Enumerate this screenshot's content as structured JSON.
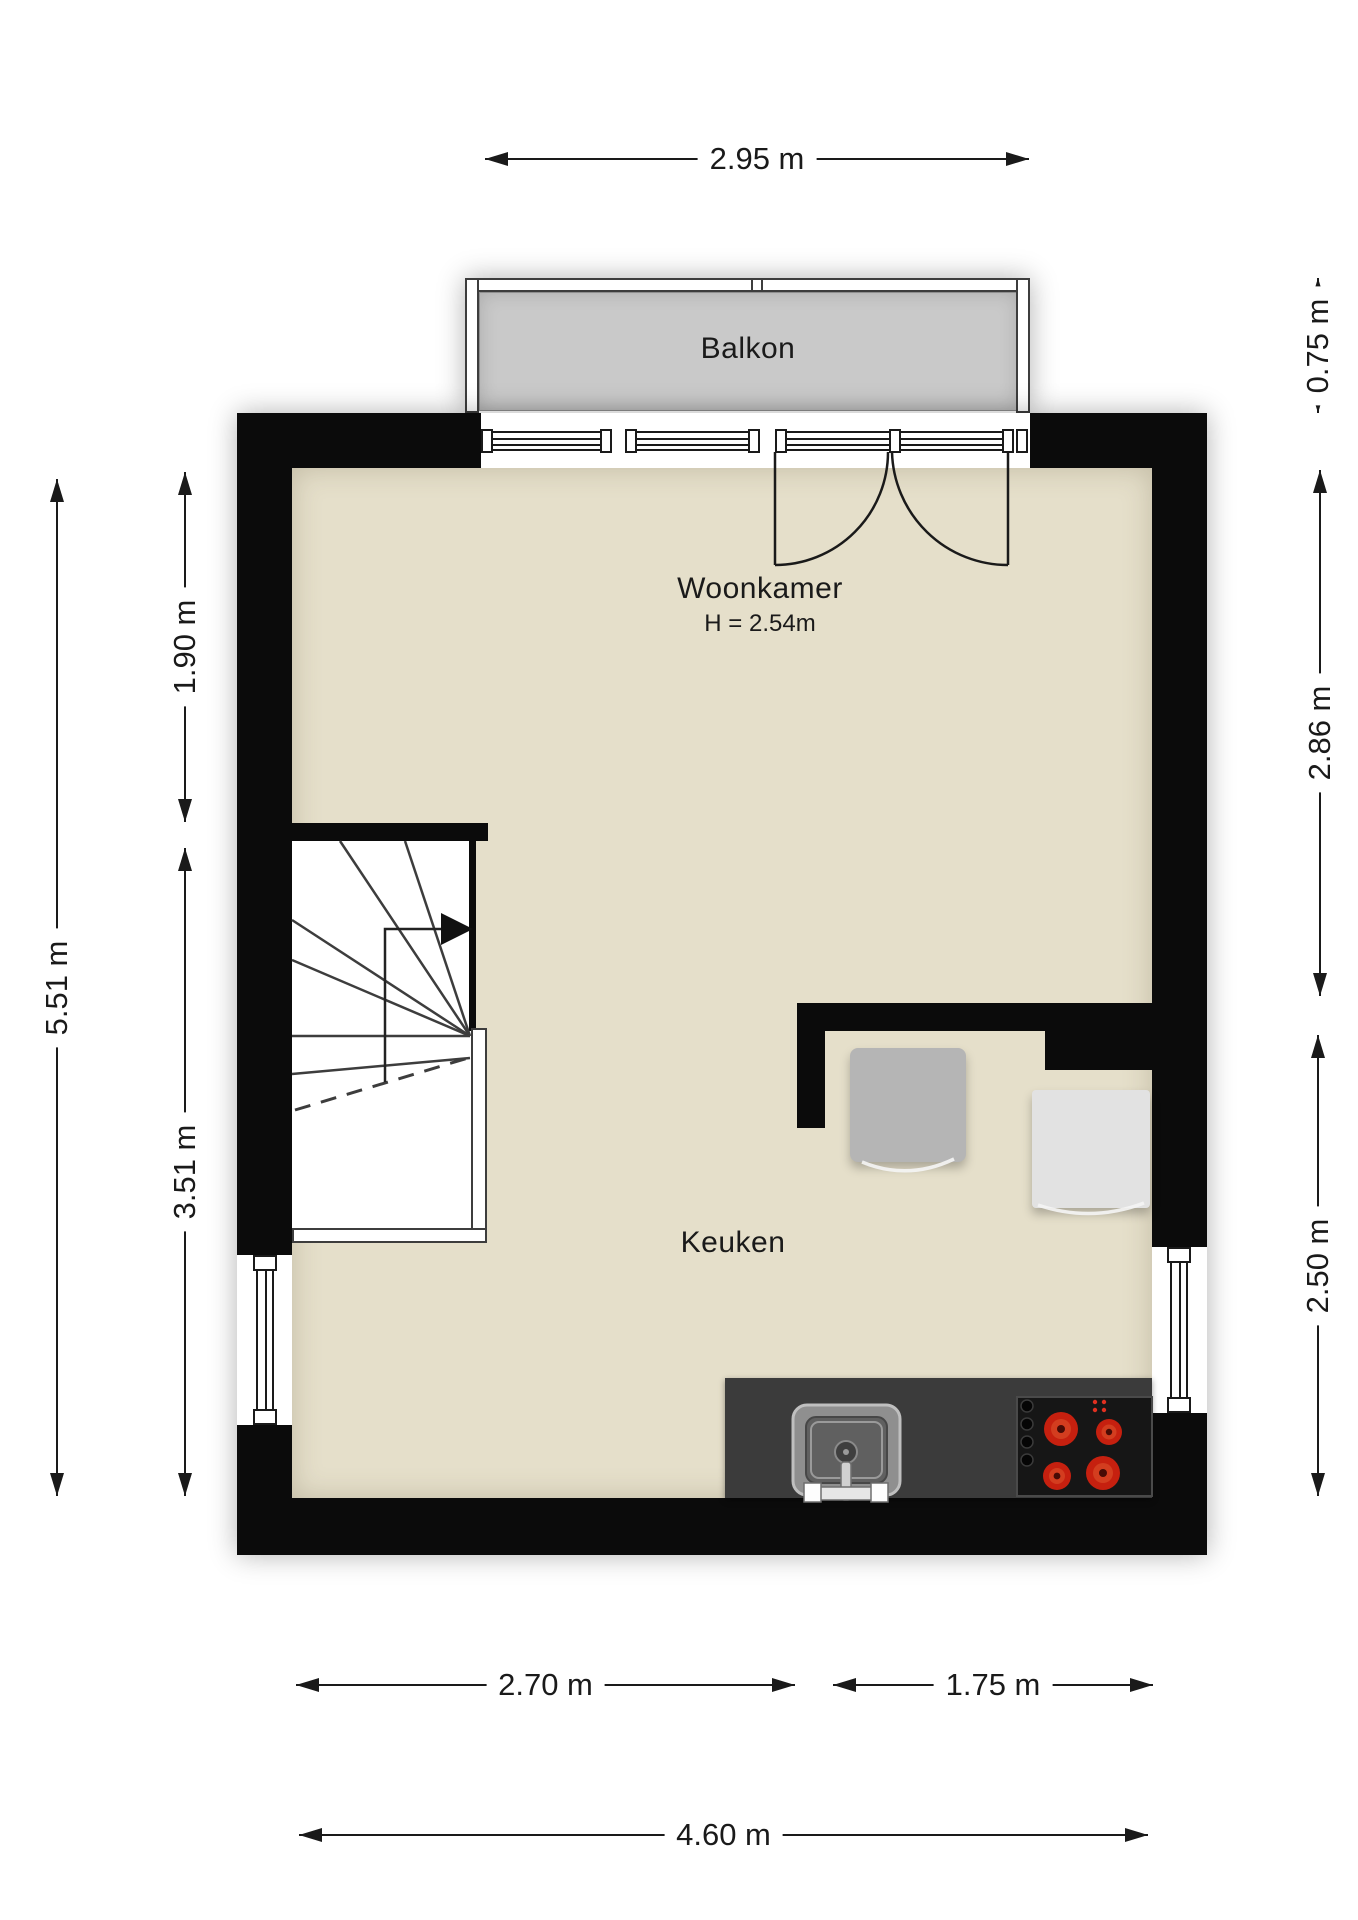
{
  "rooms": {
    "balcony_label": "Balkon",
    "living_label": "Woonkamer",
    "living_ceiling_height": "H = 2.54m",
    "kitchen_label": "Keuken"
  },
  "dimensions": {
    "top_width": "2.95 m",
    "left_total_height": "5.51 m",
    "left_upper_height": "1.90 m",
    "left_lower_height": "3.51 m",
    "right_balcony_depth": "0.75 m",
    "right_upper_height": "2.86 m",
    "right_lower_height": "2.50 m",
    "bottom_left_width": "2.70 m",
    "bottom_right_width": "1.75 m",
    "bottom_total_width": "4.60 m"
  },
  "colors": {
    "wall": "#0b0b0b",
    "floor": "#e5dfca",
    "balcony_floor": "#c9c9c9",
    "counter": "#3b3b3b",
    "cooktop": "#161616",
    "burner_red": "#c6200f",
    "chair": "#b5b5b5",
    "cabinet": "#e2e2e2",
    "dim": "#1a1a1a"
  }
}
